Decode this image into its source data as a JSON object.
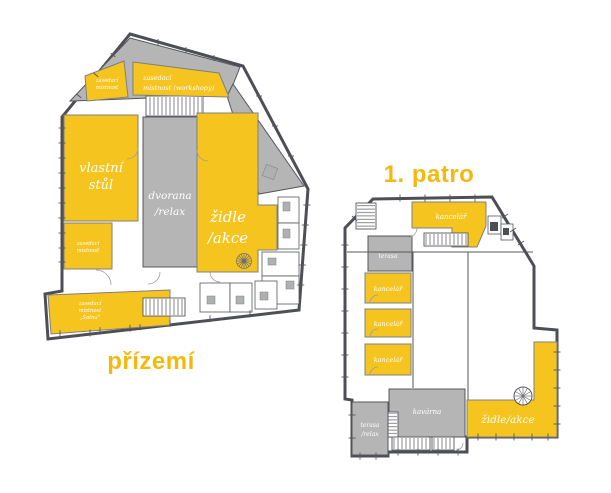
{
  "colors": {
    "accent_yellow": "#F5C41E",
    "room_gray": "#B5B5B6",
    "wall_dark": "#4D4F54",
    "room_label_text": "#FFFFFF",
    "title_text": "#F5B90E",
    "background": "#FFFFFF"
  },
  "ground_floor": {
    "title": "přízemí",
    "rooms": {
      "meeting_top": {
        "line1": "zasedací",
        "line2": "místnost"
      },
      "meeting_workshops": {
        "line1": "zasedací",
        "line2": "místnost (workshopy)"
      },
      "own_desk": {
        "line1": "vlastní",
        "line2": "stůl"
      },
      "hall_relax": {
        "line1": "dvorana",
        "line2": "/relax"
      },
      "meeting_middle": {
        "line1": "zasedací",
        "line2": "místnost"
      },
      "chairs_events": {
        "line1": "židle",
        "line2": "/akce"
      },
      "meeting_satna": {
        "line1": "zasedací",
        "line2": "místnost",
        "line3": "„Šatna“"
      }
    }
  },
  "first_floor": {
    "title": "1. patro",
    "rooms": {
      "office_top": {
        "label": "kancelář"
      },
      "terrace": {
        "label": "terasa"
      },
      "office_1": {
        "label": "kancelář"
      },
      "office_2": {
        "label": "kancelář"
      },
      "office_3": {
        "label": "kancelář"
      },
      "cafe": {
        "label": "kavárna"
      },
      "terrace_relax": {
        "line1": "terasa",
        "line2": "/relax"
      },
      "chairs_events": {
        "label": "židle/akce"
      }
    }
  }
}
